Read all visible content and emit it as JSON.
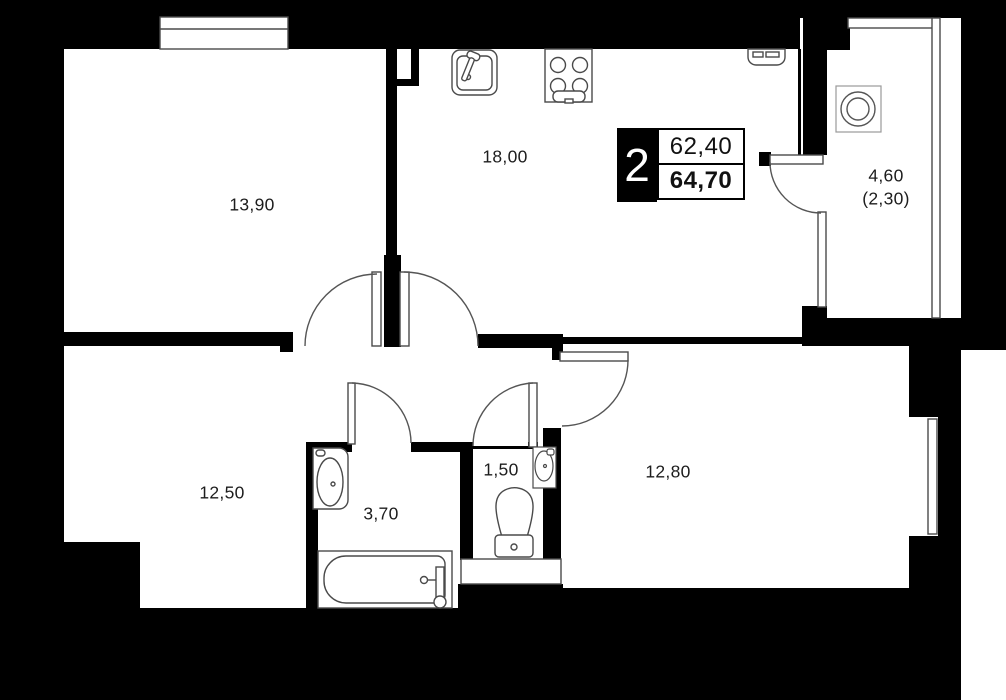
{
  "badge": {
    "rooms_count": "2",
    "area_living": "62,40",
    "area_total": "64,70"
  },
  "rooms": [
    {
      "id": "bedroom-left",
      "area": "13,90"
    },
    {
      "id": "kitchen-living",
      "area": "18,00"
    },
    {
      "id": "balcony",
      "area": "4,60",
      "area_reduced": "(2,30)"
    },
    {
      "id": "hallway",
      "area": "12,50"
    },
    {
      "id": "bathroom",
      "area": "3,70"
    },
    {
      "id": "wc",
      "area": "1,50"
    },
    {
      "id": "bedroom-right",
      "area": "12,80"
    }
  ],
  "icons": {
    "kitchen_sink": "kitchen-sink-icon",
    "stove": "stove-icon",
    "panel": "extractor-panel-icon",
    "fan": "ventilation-fan-icon",
    "washbasin": "washbasin-icon",
    "bathtub": "bathtub-icon",
    "toilet": "toilet-icon",
    "corner_sink": "corner-sink-icon"
  },
  "colors": {
    "wall": "#000000",
    "background": "#ffffff",
    "line": "#4a4a4a",
    "text": "#1d1d1d"
  }
}
